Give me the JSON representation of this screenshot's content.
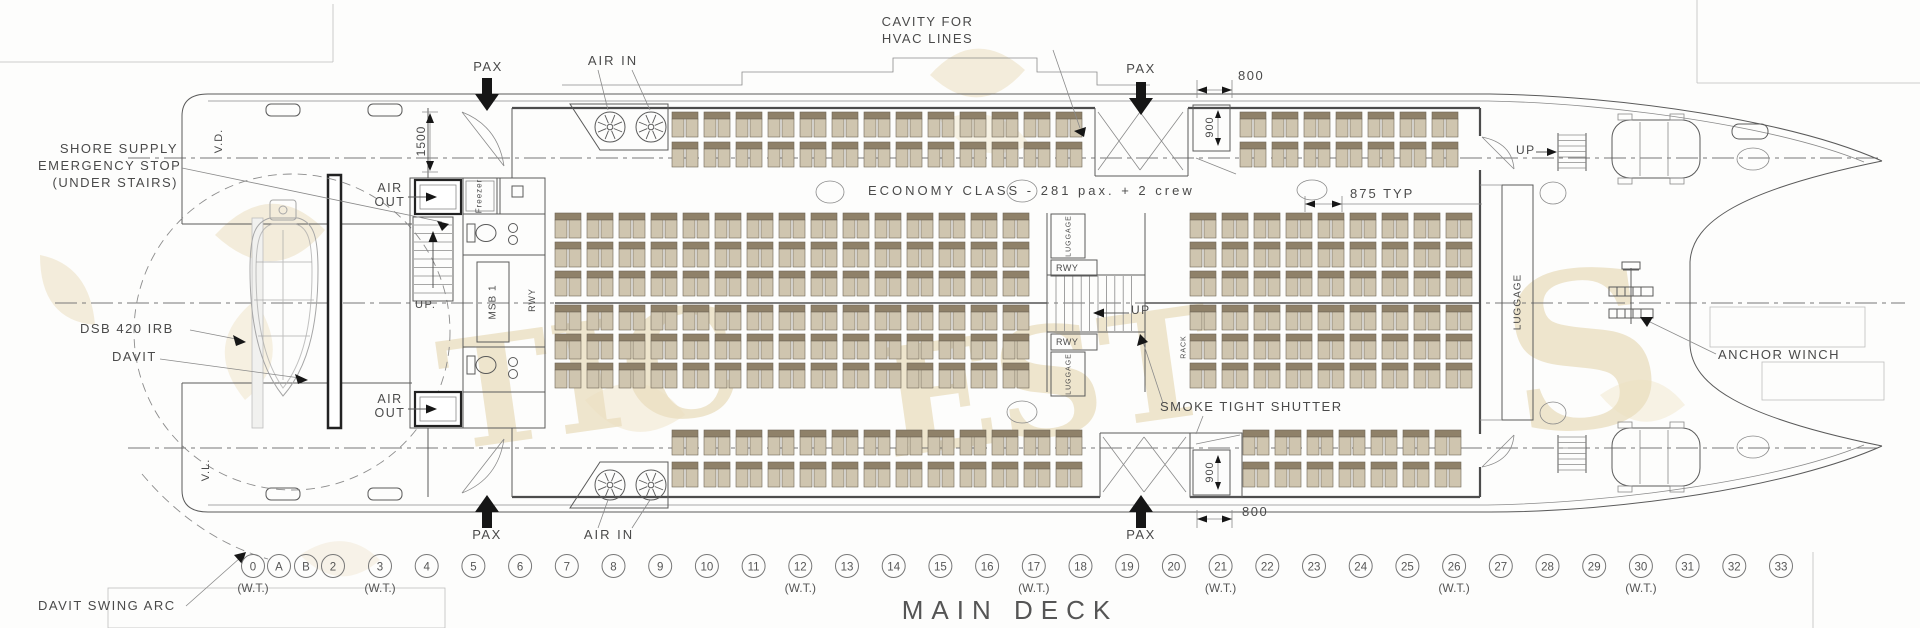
{
  "drawing": {
    "title": "MAIN DECK",
    "class_note": "ECONOMY CLASS  -  281 pax.  +  2 crew"
  },
  "labels": {
    "shore_supply": [
      "SHORE SUPPLY",
      "EMERGENCY STOP",
      "(UNDER STAIRS)"
    ],
    "cavity": [
      "CAVITY FOR",
      "HVAC LINES"
    ],
    "pax": "PAX",
    "air_in": "AIR IN",
    "air_out": [
      "AIR",
      "OUT"
    ],
    "smoke_shutter": "SMOKE TIGHT SHUTTER",
    "anchor_winch": "ANCHOR WINCH",
    "dsb_irb": "DSB 420 IRB",
    "davit": "DAVIT",
    "davit_swing_arc": "DAVIT SWING ARC",
    "up": "UP",
    "up_dot": "UP.",
    "wt": "(W.T.)",
    "luggage": "LUGGAGE",
    "rwy": "RWY",
    "rack": "RACK",
    "msb": "MSB 1",
    "freezer": "Freezer",
    "vd": "V.D.",
    "vl": "V.L."
  },
  "dimensions": {
    "vestibule": "1500",
    "door": "800",
    "shutter": "900",
    "seat_pitch": "875 TYP"
  },
  "frames": {
    "list": [
      {
        "id": "0",
        "wt": true
      },
      {
        "id": "A"
      },
      {
        "id": "B"
      },
      {
        "id": "2"
      },
      {
        "id": "3",
        "wt": true
      },
      {
        "id": "4"
      },
      {
        "id": "5"
      },
      {
        "id": "6"
      },
      {
        "id": "7"
      },
      {
        "id": "8"
      },
      {
        "id": "9"
      },
      {
        "id": "10"
      },
      {
        "id": "11"
      },
      {
        "id": "12",
        "wt": true
      },
      {
        "id": "13"
      },
      {
        "id": "14"
      },
      {
        "id": "15"
      },
      {
        "id": "16"
      },
      {
        "id": "17",
        "wt": true
      },
      {
        "id": "18"
      },
      {
        "id": "19"
      },
      {
        "id": "20"
      },
      {
        "id": "21",
        "wt": true
      },
      {
        "id": "22"
      },
      {
        "id": "23"
      },
      {
        "id": "24"
      },
      {
        "id": "25"
      },
      {
        "id": "26",
        "wt": true
      },
      {
        "id": "27"
      },
      {
        "id": "28"
      },
      {
        "id": "29"
      },
      {
        "id": "30",
        "wt": true
      },
      {
        "id": "31"
      },
      {
        "id": "32"
      },
      {
        "id": "33"
      }
    ]
  },
  "watermark": [
    "TIC",
    "EST",
    "S"
  ],
  "colors": {
    "line": "#5a5a5a",
    "seat_back": "#8f8169",
    "seat_cushion": "#cfc5af",
    "arrow": "#141414",
    "watermark": "#e4d3a6"
  }
}
